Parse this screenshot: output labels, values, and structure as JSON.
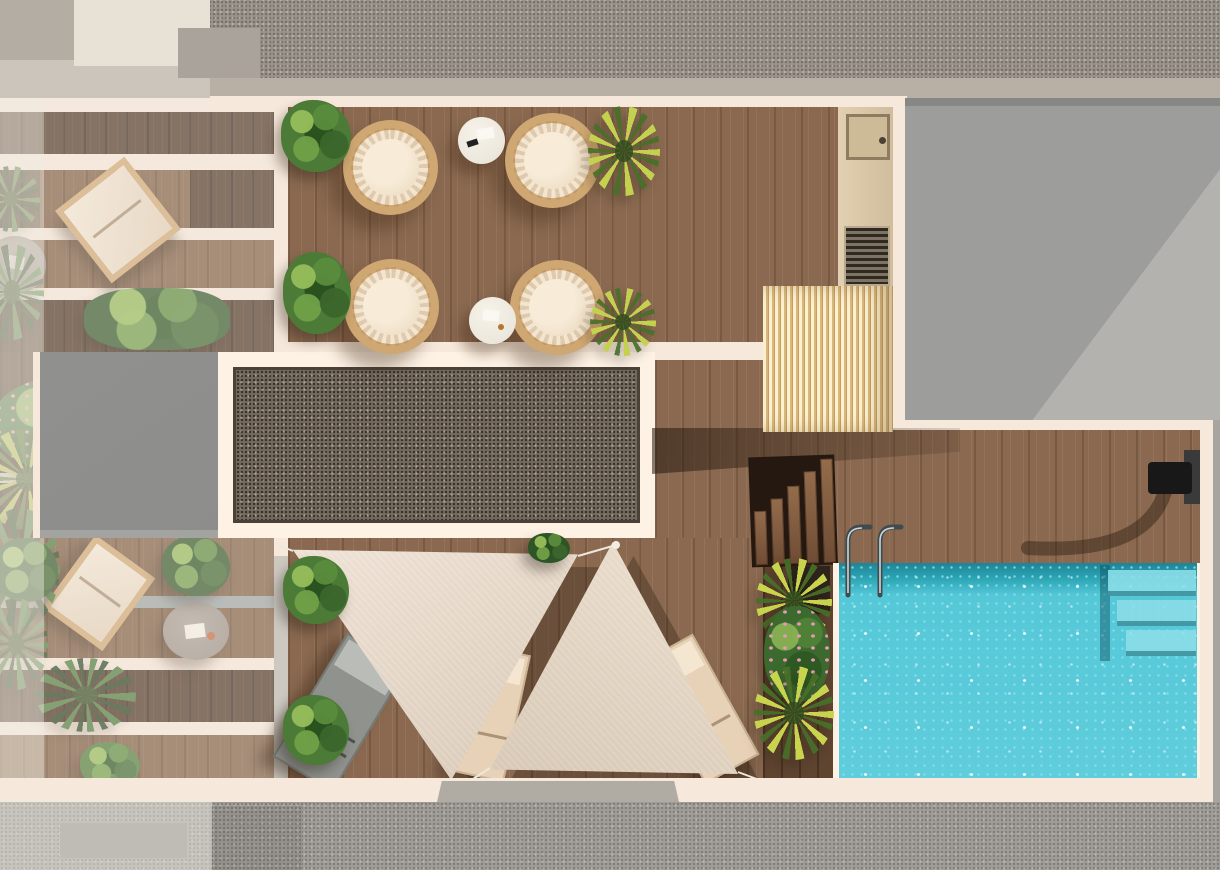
{
  "scene": {
    "render_style": "photorealistic top-down 3D architectural rendering",
    "description": "Aerial plan view of a rooftop terrace: upper lounge deck with four round wicker chairs and two white side tables, a framed gravel skylight panel, an elevator-shaft block, private side balconies with loungers, round tables and plants, a slatted pergola, a service corridor with AC unit and vent grate, wooden stairs down to a pool deck, a sparkling turquoise swimming pool with corner entry steps, ladder and outdoor shower, two beige triangular shade sails over three sun loungers, and planted beds of palms and flowering shrubs; gray streets frame the top and bottom and a neighboring flat roof sits at the right.",
    "objects": [
      "street-pavement-top",
      "sidewalk-band",
      "neighbor-roof",
      "upper-lounge-deck",
      "wicker-chairs-x4",
      "coffee-tables-x2",
      "gravel-skylight",
      "elevator-block",
      "left-balconies",
      "balcony-loungers",
      "balcony-round-tables",
      "service-corridor",
      "ac-equipment-box",
      "vent-grate",
      "slatted-pergola",
      "stairs-to-pool-deck",
      "pool-deck",
      "swimming-pool",
      "pool-entry-steps",
      "pool-ladder",
      "outdoor-shower",
      "planter-bed",
      "shade-sails-x2",
      "sun-loungers-x3",
      "plants-palms-bushes-flowers",
      "street-pavement-bottom"
    ]
  },
  "palette": {
    "asphalt_top": "#9a938b",
    "asphalt_band": "#b9b0a5",
    "pavement": "#a09d98",
    "cream": "#f6e8da",
    "cream_bright": "#fdf2e4",
    "wood_deck": "#8a6950",
    "wood_dark": "#4b3322",
    "wood_mid": "#7d5c41",
    "wood_planter": "#5f4430",
    "gravel": "#756a5f",
    "gravel_border": "#4a4138",
    "gray_block": "#8d8d8b",
    "roof_gray": "#9d9e9b",
    "roof_gray_light": "#b3b2ae",
    "edge_gray": "#a8a5a1",
    "slat_light": "#eed7a6",
    "slat_dark": "#d9b87e",
    "pool_base": "#55c8d8",
    "pool_dark": "#1f8496",
    "pool_step": "#8adee8",
    "sail_light": "#efe3d6",
    "sail_shade": "#d8c8b6",
    "lounger_gray": "#8f928d",
    "lounger_beige": "#e7d2b8",
    "wicker": "#cfa772",
    "cushion": "#f3e5cf",
    "table_white": "#e8e2d6",
    "table_taupe": "#948a81",
    "flower_pink": "#e39ab4",
    "steel_dark": "#3e4b4f"
  }
}
